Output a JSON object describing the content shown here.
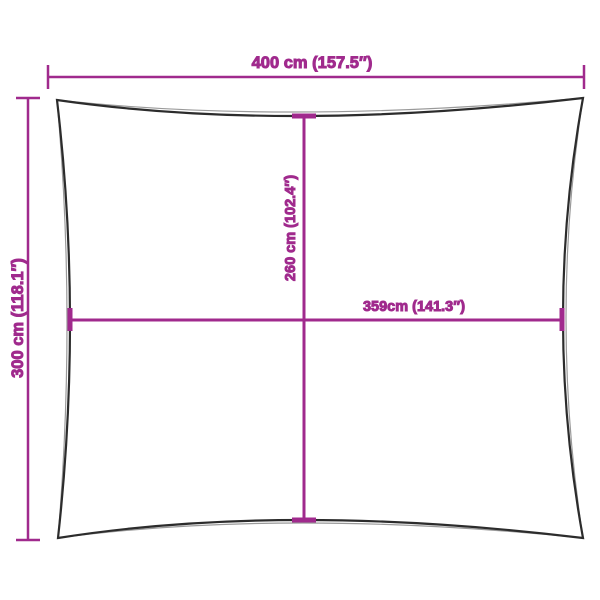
{
  "colors": {
    "dimension_accent": "#a02a8d",
    "sail_outline": "#2c2c2c",
    "sail_outline_echo": "#9a9a9a",
    "background": "#ffffff"
  },
  "diagram": {
    "subject": "rectangular-sun-shade-sail-with-concave-edges",
    "dimension_labels": {
      "top_width": "400 cm (157.5″)",
      "left_height": "300 cm (118.1″)",
      "center_height": "260 cm (102.4″)",
      "center_width": "359cm (141.3″)"
    },
    "measurements": {
      "top_width": {
        "cm": 400,
        "inches": 157.5
      },
      "left_height": {
        "cm": 300,
        "inches": 118.1
      },
      "center_height": {
        "cm": 260,
        "inches": 102.4
      },
      "center_width": {
        "cm": 359,
        "inches": 141.3
      }
    }
  }
}
